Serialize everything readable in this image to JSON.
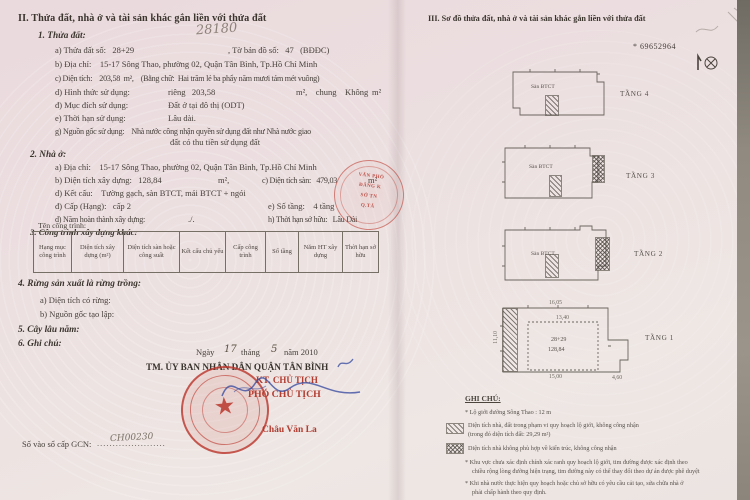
{
  "colors": {
    "accent_red": "#b23c30",
    "stamp_red": "#c0473c",
    "ink_blue": "#3f51a3",
    "text_ink": "#46403a"
  },
  "left": {
    "heading": "II. Thửa đất, nhà ở và tài sản khác gắn liền với thửa đất",
    "p1": {
      "title": "1. Thửa đất:",
      "handwriting": "28180",
      "a1": "a) Thửa đất số:   28+29",
      "a2": ", Tờ bản đồ số:   47   (BĐĐC)",
      "b": "b) Địa chỉ:    15-17 Sông Thao, phường 02, Quận Tân Bình, Tp.Hồ Chí Minh",
      "c": "c) Diện tích:    203,58  m²,    (Bằng chữ:  Hai trăm lẻ ba phẩy năm mươi tám mét vuông)",
      "d_label": "d) Hình thức sử dụng:",
      "d_private": "riêng   203,58",
      "d_common": "m²,    chung    Không",
      "d_unit": "m²",
      "dd_label": "đ) Mục đích sử dụng:",
      "dd_value": "Đất ở tại đô thị (ODT)",
      "e_label": "e) Thời hạn sử dụng:",
      "e_value": "Lâu dài.",
      "g1": "g) Nguồn gốc sử dụng:    Nhà nước công nhận quyền sử dụng đất như Nhà nước giao",
      "g2": "đất có thu tiền sử dụng đất"
    },
    "p2": {
      "title": "2. Nhà ở:",
      "a": "a) Địa chỉ:    15-17 Sông Thao, phường 02, Quận Tân Bình, Tp.Hồ Chí Minh",
      "b1": "b) Diện tích xây dựng:   128,84",
      "b2": "m²,",
      "c1": "c) Diện tích sàn:   479,03",
      "c2": "m²",
      "d": "d) Kết cấu:    Tường gạch, sàn BTCT, mái BTCT + ngói",
      "dd1": "đ) Cấp (Hạng):   cấp 2",
      "dd2": "e) Số tầng:    4 tầng",
      "e1": "d) Năm hoàn thành xây dựng:",
      "e2": "./.",
      "e3": "h) Thời hạn sở hữu:   Lâu Dài"
    },
    "p3": {
      "title": "3. Công trình xây dựng khác:",
      "sub": "Tên công trình:"
    },
    "table": {
      "headers": [
        "Hạng mục công trình",
        "Diện tích xây dựng (m²)",
        "Diện tích sàn hoặc công suất",
        "Kết cấu chủ yếu",
        "Cấp công trình",
        "Số tầng",
        "Năm HT xây dựng",
        "Thời hạn sở hữu"
      ]
    },
    "p4": {
      "title": "4. Rừng sản xuất là rừng trồng:",
      "a": "a) Diện tích có rừng:",
      "b": "b) Nguồn gốc tạo lập:"
    },
    "p5": {
      "title": "5. Cây lâu năm:"
    },
    "p6": {
      "title": "6. Ghi chú:"
    },
    "signing": {
      "date_prefix": "Ngày",
      "day": "17",
      "month_label": "tháng",
      "month": "5",
      "year_label": "năm 2010",
      "authority": "TM. ỦY BAN NHÂN DÂN QUẬN TÂN BÌNH",
      "kt": "KT. CHỦ TỊCH",
      "deputy": "PHÓ CHỦ TỊCH",
      "signer": "Châu Văn La"
    },
    "gcn": {
      "label": "Số vào sổ cấp GCN:",
      "dots": "......................",
      "number": "CH00230"
    }
  },
  "right": {
    "heading": "III. Sơ đồ thửa đất, nhà ở và tài sản khác gắn liền với thửa đất",
    "serial": "* 69652964",
    "floors": [
      {
        "label": "TẦNG 4"
      },
      {
        "label": "TẦNG 3"
      },
      {
        "label": "TẦNG 2"
      },
      {
        "label": "TẦNG 1"
      }
    ],
    "san_btct": "Sàn BTCT",
    "parcel_no": "28+29",
    "parcel_area": "128,84",
    "dims": {
      "top": "16,05",
      "bottom": "15,00",
      "left": "11,10",
      "inner": "13,40",
      "right": "4,60"
    },
    "fold_stamp": {
      "l1": "VĂN PHÒ",
      "l2": "ĐĂNG K",
      "l3": "SỞ TN",
      "l4": "Q.TÂ"
    },
    "legend": {
      "title": "GHI CHÚ:",
      "l1": "* Lộ giới đường Sông Thao : 12 m",
      "i1a": "Diện tích nhà, đất trong phạm vi quy hoạch lộ giới, không công nhận",
      "i1b": "(trong đó diện tích đất: 29,29 m²)",
      "i2": "Diện tích nhà không phù hợp về kiến trúc, không công nhận",
      "l4a": "* Khu vực chưa xác định chính xác ranh quy hoạch lộ giới, tim đường được xác định theo",
      "l4b": "chiều rộng lòng đường hiện trạng, tim đường này có thể thay đổi theo dự án được phê duyệt",
      "l5a": "* Khi nhà nước thực hiện quy hoạch hoặc chủ sở hữu có yêu cầu cải tạo, sửa chữa nhà ở",
      "l5b": "phải chấp hành theo quy định."
    }
  }
}
